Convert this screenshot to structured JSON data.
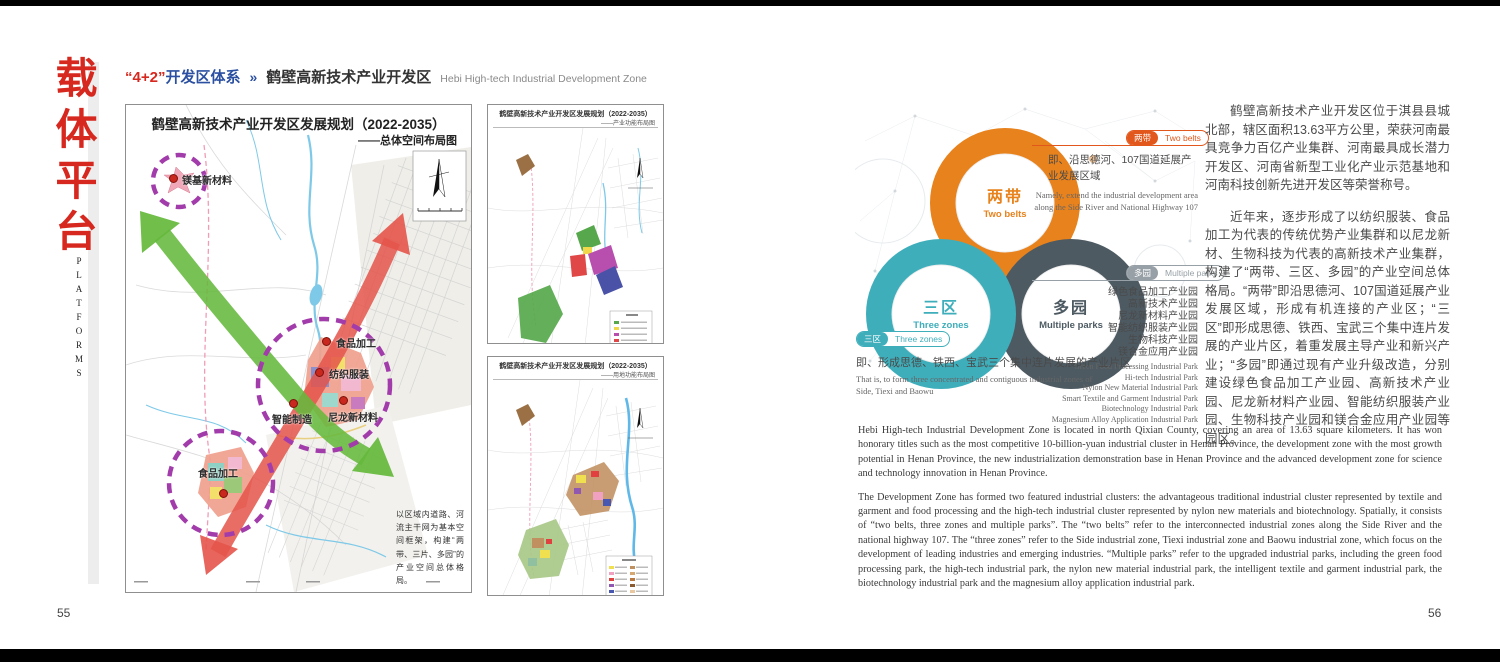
{
  "colors": {
    "accent_red": "#d6281e",
    "accent_blue": "#2b50a1",
    "belts_orange": "#e8821c",
    "zones_teal": "#3faebb",
    "parks_dark": "#4d5a62",
    "tag_orange": "#e2571b",
    "tag_gray": "#97a0a6"
  },
  "left_page": {
    "page_number": "55",
    "sidebar": {
      "title": "载体平台",
      "subtitle": "PLATFORMS"
    },
    "header": {
      "series_red": "“4+2”",
      "series_blue": "开发区体系",
      "arrow": "»",
      "title_cn": "鹤壁高新技术产业开发区",
      "title_en": "Hebi High-tech Industrial Development Zone"
    },
    "main_map": {
      "title": "鹤壁高新技术产业开发区发展规划（2022-2035）",
      "subtitle": "——总体空间布局图",
      "labels": [
        "镁基新材料",
        "食品加工",
        "纺织服装",
        "智能制造",
        "尼龙新材料",
        "食品加工"
      ],
      "note": "以区域内道路、河流主干网为基本空间框架，构建“两带、三片、多园”的产业空间总体格局。"
    },
    "small_maps": [
      {
        "title": "鹤壁高新技术产业开发区发展规划（2022-2035）",
        "subtitle": "——产业功能布局图"
      },
      {
        "title": "鹤壁高新技术产业开发区发展规划（2022-2035）",
        "subtitle": "——用地功能布局图"
      }
    ]
  },
  "right_page": {
    "page_number": "56",
    "diagram": {
      "belts": {
        "cn": "两带",
        "en": "Two belts"
      },
      "zones": {
        "cn": "三区",
        "en": "Three zones"
      },
      "parks": {
        "cn": "多园",
        "en": "Multiple parks"
      },
      "belts_note_cn": "即、沿思德河、107国道延展产业发展区域",
      "belts_note_en": "Namely, extend the industrial development area along the Side River and National Highway 107",
      "zones_note_cn": "即、形成思德、铁西、宝武三个集中连片发展的产业片区",
      "zones_note_en": "That is, to form three concentrated and contiguous industrial zones of Side, Tiexi and Baowu",
      "parks_list_cn": [
        "绿色食品加工产业园",
        "高新技术产业园",
        "尼龙新材料产业园",
        "智能纺织服装产业园",
        "生物科技产业园",
        "镁合金应用产业园"
      ],
      "parks_list_en": [
        "Green Food Processing Industrial Park",
        "Hi-tech Industrial Park",
        "Nylon New Material Industrial Park",
        "Smart Textile and Garment Industrial Park",
        "Biotechnology Industrial Park",
        "Magnesium Alloy Application Industrial Park"
      ]
    },
    "body_cn": {
      "p1": "鹤壁高新技术产业开发区位于淇县县城北部，辖区面积13.63平方公里，荣获河南最具竞争力百亿产业集群、河南最具成长潜力开发区、河南省新型工业化产业示范基地和河南科技创新先进开发区等荣誉称号。",
      "p2": "近年来，逐步形成了以纺织服装、食品加工为代表的传统优势产业集群和以尼龙新材、生物科技为代表的高新技术产业集群，构建了“两带、三区、多园”的产业空间总体格局。“两带”即沿思德河、107国道延展产业发展区域，形成有机连接的产业区；“三区”即形成思德、铁西、宝武三个集中连片发展的产业片区，着重发展主导产业和新兴产业；“多园”即通过现有产业升级改造，分别建设绿色食品加工产业园、高新技术产业园、尼龙新材料产业园、智能纺织服装产业园、生物科技产业园和镁合金应用产业园等园区。"
    },
    "body_en": {
      "p1": "Hebi High-tech Industrial Development Zone is located in north Qixian County, covering an area of 13.63 square kilometers. It has won honorary titles such as the most competitive 10-billion-yuan industrial cluster in Henan Province, the development zone with the most growth potential in Henan Province, the new industrialization demonstration base in Henan Province and the advanced development zone for science and technology innovation in Henan Province.",
      "p2": "The Development Zone has formed two featured industrial clusters: the advantageous traditional industrial cluster represented by textile and garment and food processing and the high-tech industrial cluster represented by nylon new materials and biotechnology. Spatially, it consists of “two belts, three zones and multiple parks”. The “two belts” refer to the interconnected industrial zones along the Side River and the national highway 107. The “three zones” refer to the Side industrial zone, Tiexi industrial zone and Baowu industrial zone, which focus on the development of leading industries and emerging industries. “Multiple parks” refer to the upgraded industrial parks, including the green food processing park, the high-tech industrial park, the nylon new material industrial park, the intelligent textile and garment industrial park, the biotechnology industrial park and the magnesium alloy application industrial park."
    }
  }
}
